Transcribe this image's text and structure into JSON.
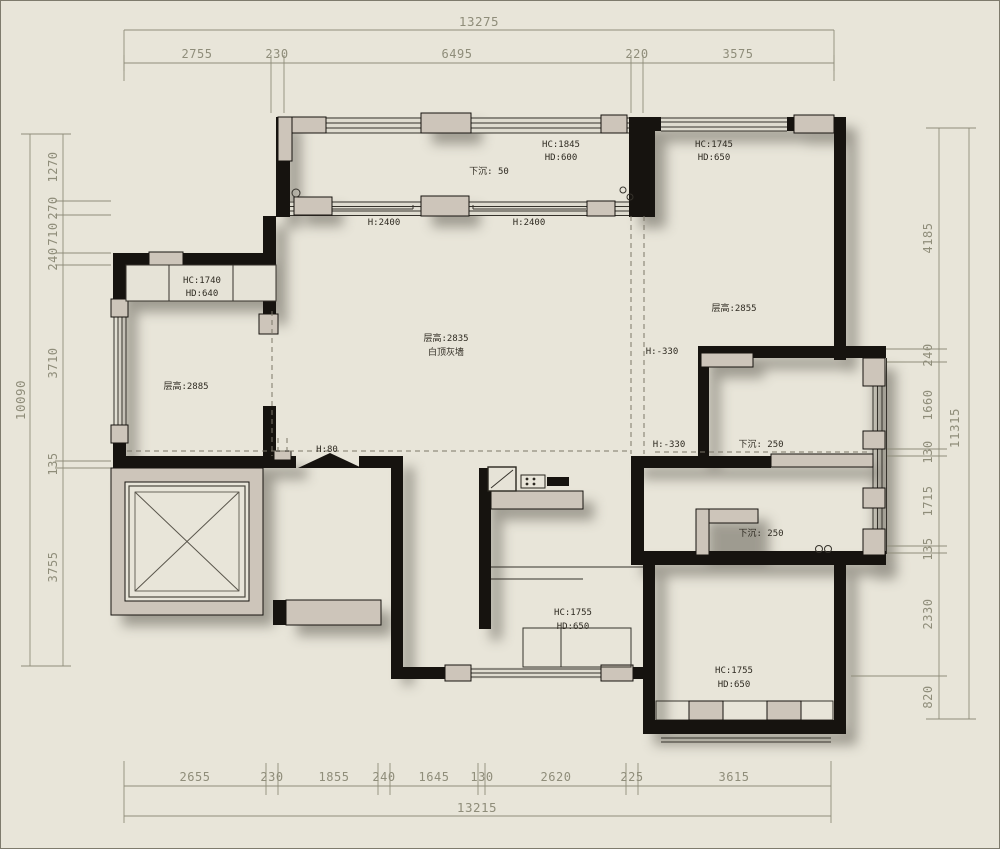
{
  "colors": {
    "background": "#e8e5d9",
    "wall": "#16130f",
    "pier": "#cdc5ba",
    "dimension": "#8f8d7a",
    "label": "#2f2b22"
  },
  "dims": {
    "top": {
      "overall": "13275",
      "segments": [
        "2755",
        "230",
        "6495",
        "220",
        "3575"
      ]
    },
    "bottom": {
      "overall": "13215",
      "segments": [
        "2655",
        "230",
        "1855",
        "240",
        "1645",
        "130",
        "2620",
        "225",
        "3615"
      ]
    },
    "left": {
      "overall": "10090",
      "segments": [
        "1270",
        "270",
        "710",
        "240",
        "3710",
        "135",
        "3755"
      ]
    },
    "right": {
      "overall": "11315",
      "segments": [
        "4185",
        "240",
        "1660",
        "130",
        "1715",
        "135",
        "2330",
        "820"
      ]
    }
  },
  "rooms": {
    "balcony_top": {
      "hc": "HC:1845",
      "hd": "HD:600",
      "sunken": "下沉: 50"
    },
    "bedroom_tr": {
      "hc": "HC:1745",
      "hd": "HD:650",
      "height": "层高:2855"
    },
    "living": {
      "height": "层高:2835",
      "finish": "白顶灰墙",
      "win_left": "H:2400",
      "win_right": "H:2400",
      "entry_step": "H:80",
      "drop_edge": "H:-330"
    },
    "bedroom_left": {
      "hc": "HC:1740",
      "hd": "HD:640",
      "height": "层高:2885"
    },
    "balcony_r1": {
      "sunken": "下沉: 250",
      "drop": "H:-330"
    },
    "balcony_r2": {
      "sunken": "下沉: 250"
    },
    "bath": {
      "hc": "HC:1755",
      "hd": "HD:650"
    },
    "bedroom_br": {
      "hc": "HC:1755",
      "hd": "HD:650"
    }
  }
}
